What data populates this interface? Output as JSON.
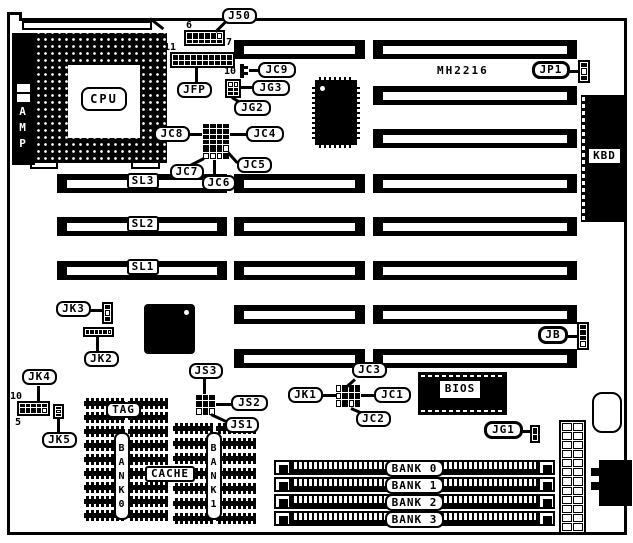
{
  "board": {
    "model": "MH2216"
  },
  "chips": {
    "cpu": "CPU",
    "amp": "AMP",
    "kbd": "KBD",
    "bios": "BIOS"
  },
  "slots": {
    "sl1": "SL1",
    "sl2": "SL2",
    "sl3": "SL3"
  },
  "connectors": {
    "j50": "J50",
    "jfp": "JFP",
    "jp1": "JP1",
    "jb": "JB",
    "jc1": "JC1",
    "jc2": "JC2",
    "jc3": "JC3",
    "jc4": "JC4",
    "jc5": "JC5",
    "jc6": "JC6",
    "jc7": "JC7",
    "jc8": "JC8",
    "jc9": "JC9",
    "jg1": "JG1",
    "jg2": "JG2",
    "jg3": "JG3",
    "jk1": "JK1",
    "jk2": "JK2",
    "jk3": "JK3",
    "jk4": "JK4",
    "jk5": "JK5",
    "js1": "JS1",
    "js2": "JS2",
    "js3": "JS3"
  },
  "memory": {
    "bank0": "BANK 0",
    "bank1": "BANK 1",
    "bank2": "BANK 2",
    "bank3": "BANK 3"
  },
  "cache": {
    "tag": "TAG",
    "label": "CACHE",
    "bank0": "BANK0",
    "bank1": "BANK1"
  },
  "pins": {
    "j50_pin6": "6",
    "j50_pin7": "7",
    "jfp_pin11": "11",
    "jc9_pin10": "10",
    "jk4_pin10": "10",
    "jk4_pin5": "5"
  },
  "colors": {
    "ink": "#000000",
    "paper": "#ffffff"
  }
}
